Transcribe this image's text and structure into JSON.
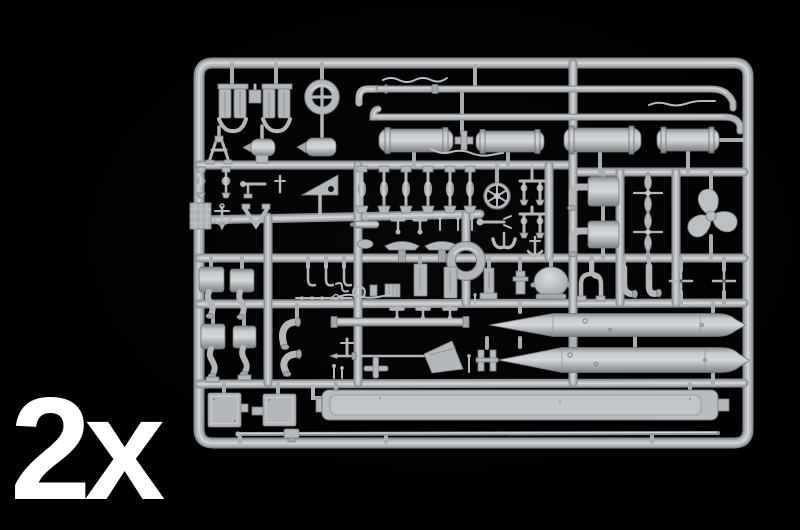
{
  "scene": {
    "type": "product-photo",
    "subject": "injection-moulded plastic model kit sprue (parts frame) on black background",
    "quantity_label": "2x"
  },
  "colors": {
    "background": "#000000",
    "plastic_base": "#b4b8bc",
    "plastic_highlight": "#d2d5d8",
    "plastic_shadow": "#7e8388",
    "label_text": "#ffffff"
  },
  "parts_visible": [
    "rudder-fin-pairs",
    "handwheel-ring",
    "elbow-pipes",
    "long-deck-pipes",
    "wavy-cable-railings",
    "compressed-air-flasks",
    "davit-tripod",
    "anchor",
    "stamped-plate",
    "bollard-posts",
    "ships-helm-wheel",
    "deck-stanchions",
    "exhaust-mufflers-with-pipes",
    "four-blade-propellers",
    "three-blade-propeller",
    "large-ring-eyelet",
    "dome-vent",
    "hatch-brackets",
    "torpedo-upper-half",
    "torpedo-lower-half",
    "mast-rods",
    "funnel-cone",
    "deck-hooks",
    "square-hatch-panels",
    "long-deck-plank",
    "thin-antenna-rod"
  ]
}
